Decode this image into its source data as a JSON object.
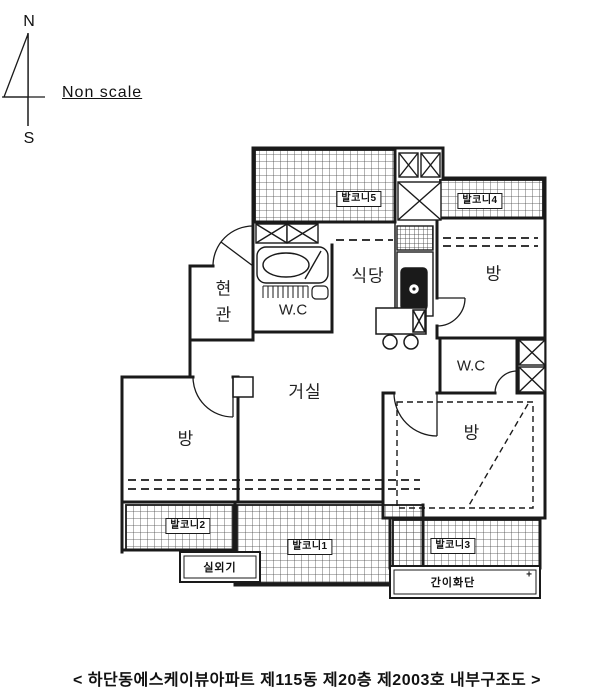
{
  "colors": {
    "ink": "#1a1a1a",
    "paper": "#ffffff"
  },
  "compass": {
    "north": "N",
    "south": "S"
  },
  "scale_note": "Non scale",
  "plan": {
    "balcony1": "발코니1",
    "balcony2": "발코니2",
    "balcony3": "발코니3",
    "balcony4": "발코니4",
    "balcony5": "발코니5",
    "entrance": "현관",
    "wc_top": "W.C",
    "wc_right": "W.C",
    "dining": "식당",
    "living": "거실",
    "room_top_right": "방",
    "room_left": "방",
    "room_bottom_right": "방",
    "outdoor_unit": "실외기",
    "flower_bed": "간이화단",
    "flower_bed_marker": "+"
  },
  "caption": "< 하단동에스케이뷰아파트 제115동 제20층 제2003호 내부구조도 >"
}
